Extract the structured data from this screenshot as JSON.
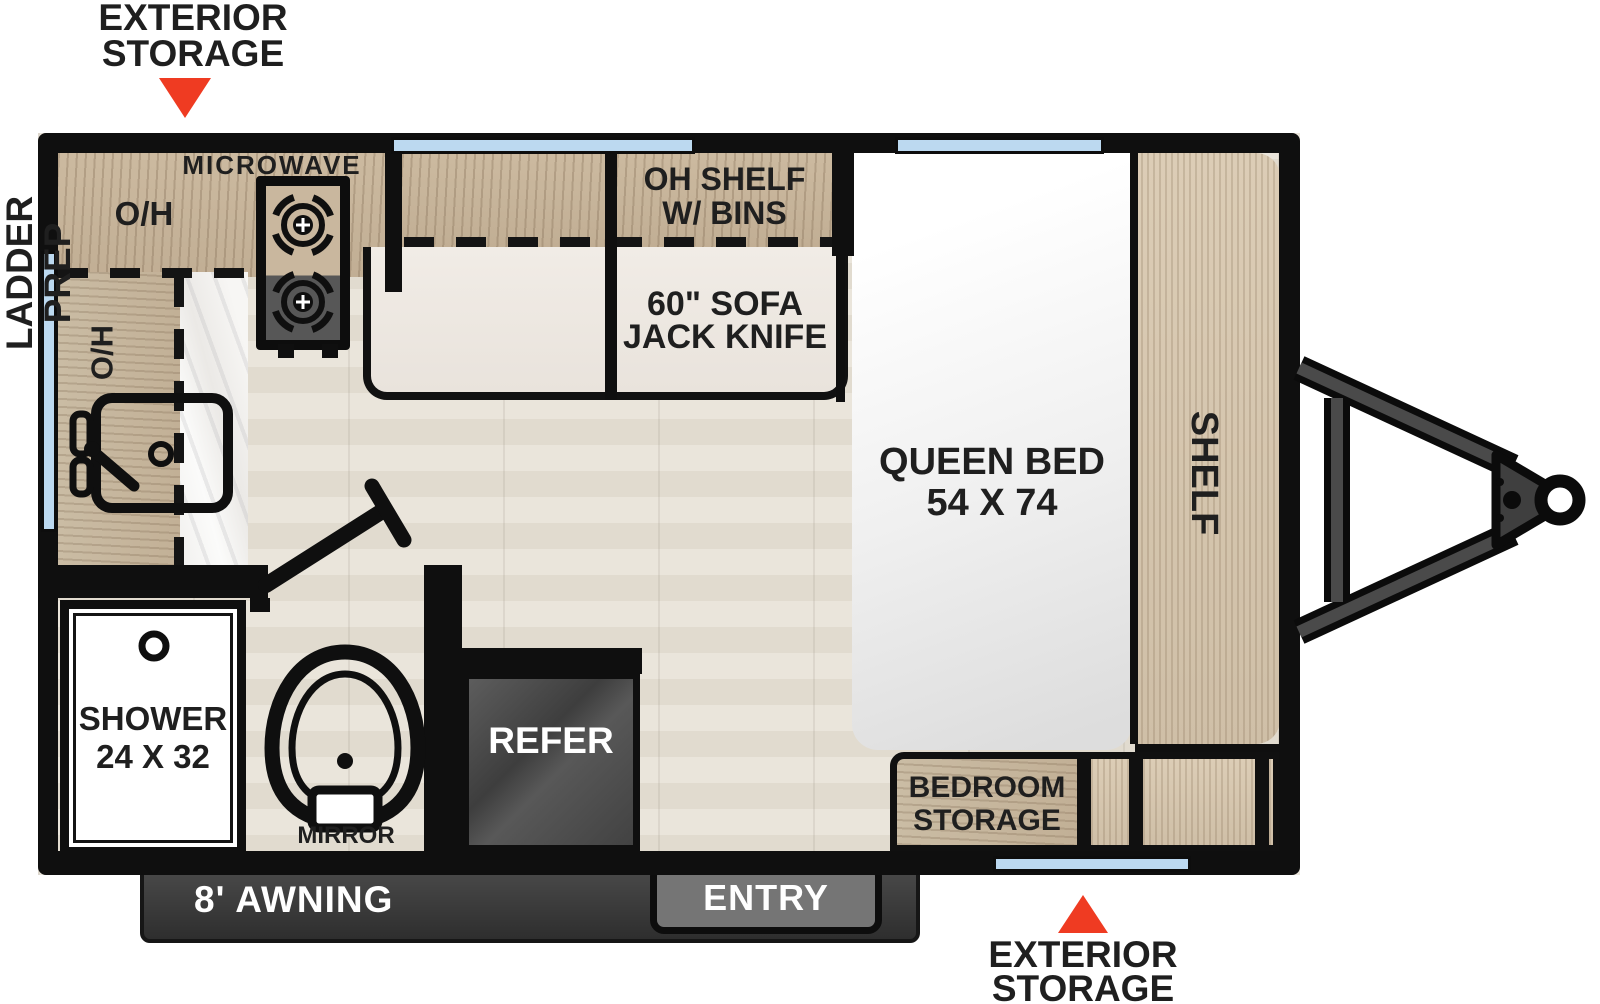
{
  "colors": {
    "wall": "#0f0f0f",
    "window_glass": "#bcd9f0",
    "cabinet_wood": "#c7b59d",
    "shelf_wood": "#d8c9b2",
    "floor": "#e7e2d8",
    "sofa_cream": "#ece7e0",
    "bed_white": "#ffffff",
    "marble": "#f4f3f1",
    "refer_gray": "#4a4a4a",
    "awning_gray": "#3a3a3a",
    "entry_gray": "#757575",
    "callout_red": "#ef3b22",
    "label_dark": "#1f1f1f"
  },
  "callouts": {
    "exterior_storage_top": {
      "line1": "EXTERIOR",
      "line2": "STORAGE"
    },
    "exterior_storage_bottom": {
      "line1": "EXTERIOR",
      "line2": "STORAGE"
    },
    "ladder_prep": "LADDER PREP"
  },
  "kitchen": {
    "microwave": "MICROWAVE",
    "overhead_top": "O/H",
    "overhead_left": "O/H"
  },
  "living": {
    "oh_shelf": {
      "line1": "OH SHELF",
      "line2": "W/ BINS"
    },
    "sofa": {
      "line1": "60\" SOFA",
      "line2": "JACK KNIFE"
    }
  },
  "bedroom": {
    "queen_bed": {
      "line1": "QUEEN BED",
      "line2": "54 X 74"
    },
    "shelf": "SHELF",
    "bedroom_storage": {
      "line1": "BEDROOM",
      "line2": "STORAGE"
    }
  },
  "bathroom": {
    "shower": {
      "line1": "SHOWER",
      "line2": "24 X 32"
    },
    "mirror": "MIRROR"
  },
  "appliances": {
    "refer": "REFER"
  },
  "exterior_features": {
    "entry": "ENTRY",
    "awning": "8' AWNING"
  }
}
